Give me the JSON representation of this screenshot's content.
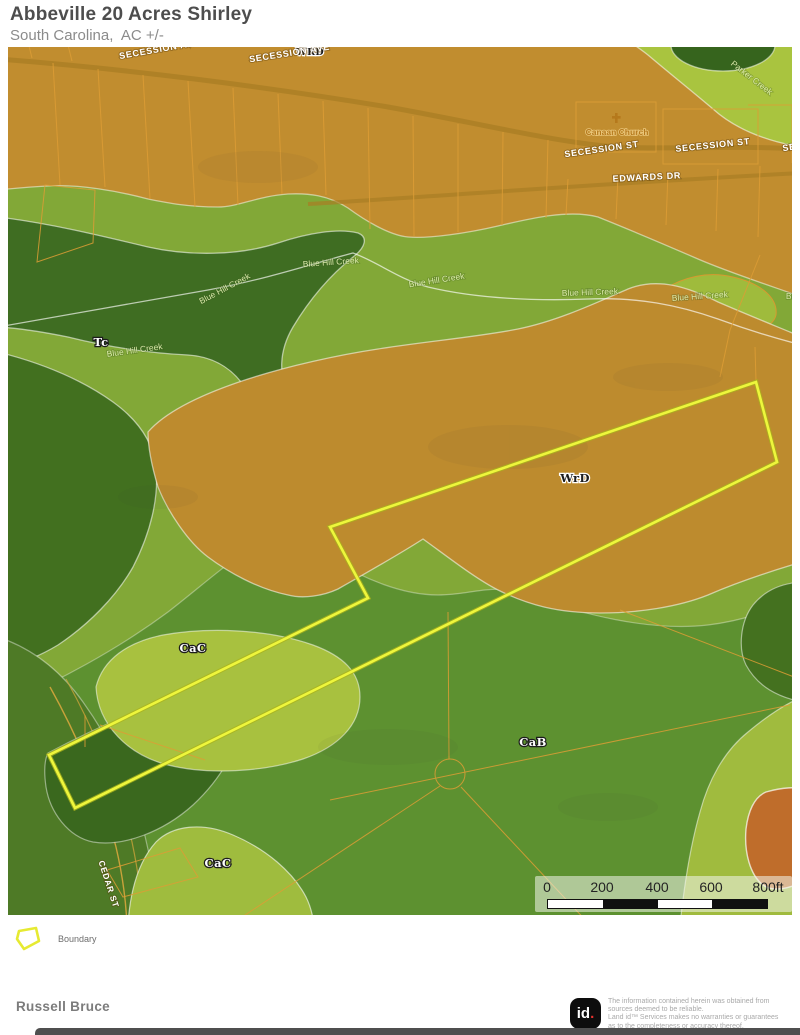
{
  "header": {
    "title": "Abbeville 20 Acres Shirley",
    "subtitle": "South Carolina,  AC +/-"
  },
  "map": {
    "labels": [
      {
        "text": "WRD",
        "x": 302,
        "y": 8,
        "rot": 0,
        "cls": "soil-dark soil-sm"
      },
      {
        "text": "SECESSION AVE",
        "x": 152,
        "y": 5,
        "rot": -10,
        "cls": "road"
      },
      {
        "text": "SECESSION AVE",
        "x": 282,
        "y": 9,
        "rot": -9,
        "cls": "road"
      },
      {
        "text": "SECESSION ST",
        "x": 594,
        "y": 105,
        "rot": -8,
        "cls": "road"
      },
      {
        "text": "SECESSION ST",
        "x": 705,
        "y": 101,
        "rot": -6,
        "cls": "road"
      },
      {
        "text": "SECESSION ST",
        "x": 812,
        "y": 99,
        "rot": -8,
        "cls": "road"
      },
      {
        "text": "EDWARDS DR",
        "x": 639,
        "y": 133,
        "rot": -3,
        "cls": "road"
      },
      {
        "text": "Canaan Church",
        "x": 609,
        "y": 88,
        "rot": 0,
        "cls": "poi"
      },
      {
        "text": "Parker Creek",
        "x": 742,
        "y": 33,
        "rot": 38,
        "cls": "creek"
      },
      {
        "text": "Blue Hill Creek",
        "x": 127,
        "y": 306,
        "rot": -8,
        "cls": "creek"
      },
      {
        "text": "Blue Hill Creek",
        "x": 218,
        "y": 244,
        "rot": -28,
        "cls": "creek"
      },
      {
        "text": "Blue Hill Creek",
        "x": 323,
        "y": 218,
        "rot": -4,
        "cls": "creek"
      },
      {
        "text": "Blue Hill Creek",
        "x": 429,
        "y": 236,
        "rot": -9,
        "cls": "creek"
      },
      {
        "text": "Blue Hill Creek",
        "x": 582,
        "y": 248,
        "rot": -2,
        "cls": "creek"
      },
      {
        "text": "Blue Hill Creek",
        "x": 692,
        "y": 252,
        "rot": -4,
        "cls": "creek"
      },
      {
        "text": "Blue Hill Creek",
        "x": 806,
        "y": 252,
        "rot": 0,
        "cls": "creek"
      },
      {
        "text": "Tc",
        "x": 93,
        "y": 299,
        "rot": 0,
        "cls": "soil"
      },
      {
        "text": "WrD",
        "x": 567,
        "y": 435,
        "rot": 0,
        "cls": "soil-dark"
      },
      {
        "text": "CaC",
        "x": 185,
        "y": 605,
        "rot": 0,
        "cls": "soil"
      },
      {
        "text": "CaB",
        "x": 525,
        "y": 699,
        "rot": 0,
        "cls": "soil"
      },
      {
        "text": "CaC",
        "x": 210,
        "y": 820,
        "rot": 0,
        "cls": "soil"
      },
      {
        "text": "CEDAR ST",
        "x": 98,
        "y": 838,
        "rot": 72,
        "cls": "road road-sm"
      }
    ],
    "scale_bar": {
      "ticks": [
        {
          "label": "0",
          "x": 12
        },
        {
          "label": "200",
          "x": 67
        },
        {
          "label": "400",
          "x": 122
        },
        {
          "label": "600",
          "x": 176
        },
        {
          "label": "800ft",
          "x": 233
        }
      ]
    },
    "colors": {
      "boundary_yellow": "#eef63c",
      "soil_wrd_orange": "#bd8b2e",
      "soil_tc_dark_green": "#3f6d22",
      "soil_cac_light_green": "#a8c13f",
      "soil_cab_green": "#5d9130",
      "parcel_line_orange": "#dd9d35",
      "creek_border_white": "rgba(255,255,255,0.65)"
    }
  },
  "legend": {
    "items": [
      {
        "label": "Boundary"
      }
    ]
  },
  "footer": {
    "author": "Russell Bruce",
    "logo": {
      "text": "id",
      "dot": "."
    },
    "disclaimer_lines": [
      "The information contained herein was obtained from",
      "sources deemed to be reliable.",
      " Land id™ Services makes no warranties or guarantees",
      "as to the completeness or accuracy thereof."
    ]
  }
}
